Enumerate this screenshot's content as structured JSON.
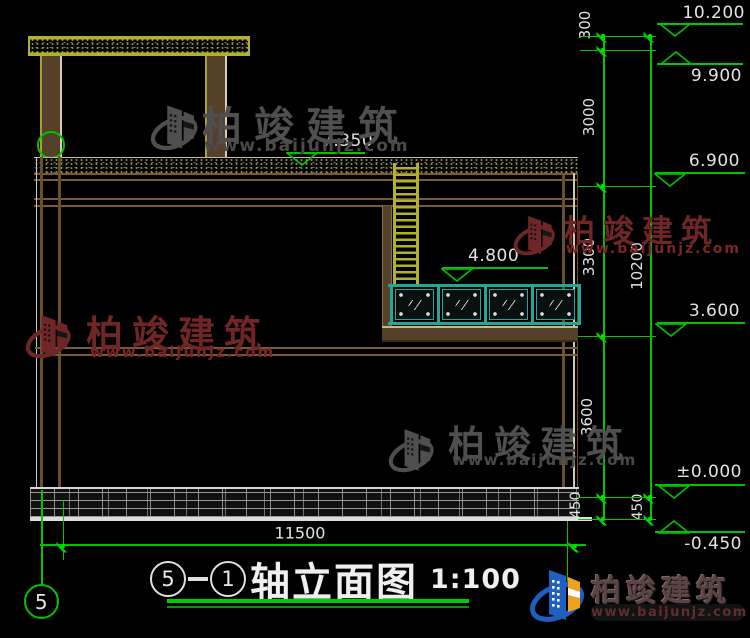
{
  "title_bar": {
    "axis_a": "5",
    "axis_b": "1",
    "name": "轴立面图",
    "scale": "1:100"
  },
  "axis_bubble_label": "5",
  "brand": {
    "name": "柏竣建筑",
    "site": "www.baijunjz.com"
  },
  "colors": {
    "dim_green": "#00c400",
    "cad_yellow": "#b2b22a",
    "wall_brown": "#7a5a35",
    "rail_teal": "#1fa89a",
    "wm_gray": "#4f4f4f",
    "wm_red": "#702626",
    "logo_blue": "#1e5fc0",
    "logo_orange": "#f0a21e"
  },
  "drawing": {
    "bottom_dimension": {
      "label": "11500",
      "cx": 300,
      "cy": 533,
      "line": [
        40,
        586,
        545
      ],
      "tick_x": [
        63,
        575
      ]
    },
    "elevation_markers": [
      {
        "label": "10.200",
        "line": [
          657,
          743,
          23
        ],
        "apex": [
          675,
          35
        ],
        "dir": "down",
        "text": [
          745,
          3,
          "right"
        ]
      },
      {
        "label": "9.900",
        "line": [
          657,
          743,
          63
        ],
        "apex": [
          676,
          50
        ],
        "dir": "up",
        "text": [
          742,
          66,
          "right"
        ]
      },
      {
        "label": "6.900",
        "line": [
          655,
          745,
          172
        ],
        "apex": [
          670,
          185
        ],
        "dir": "down",
        "text": [
          740,
          151,
          "right"
        ]
      },
      {
        "label": "3.600",
        "line": [
          657,
          745,
          322
        ],
        "apex": [
          671,
          335
        ],
        "dir": "down",
        "text": [
          740,
          301,
          "right"
        ]
      },
      {
        "label": "±0.000",
        "line": [
          655,
          745,
          484
        ],
        "apex": [
          674,
          497
        ],
        "dir": "down",
        "text": [
          742,
          462,
          "right"
        ]
      },
      {
        "label": "-0.450",
        "line": [
          655,
          745,
          531
        ],
        "apex": [
          674,
          519
        ],
        "dir": "up",
        "text": [
          742,
          534,
          "right"
        ]
      },
      {
        "label": "7.350",
        "line": [
          287,
          365,
          152
        ],
        "apex": [
          302,
          164
        ],
        "dir": "down",
        "text": [
          322,
          131,
          "left"
        ]
      },
      {
        "label": "4.800",
        "line": [
          442,
          548,
          267
        ],
        "apex": [
          457,
          280
        ],
        "dir": "down",
        "text": [
          468,
          246,
          "left"
        ]
      }
    ],
    "dim_chain_labels": [
      {
        "text": "300",
        "cx": 585,
        "cy": 25,
        "size": 15
      },
      {
        "text": "3000",
        "cx": 589,
        "cy": 117,
        "size": 15
      },
      {
        "text": "3300",
        "cx": 589,
        "cy": 257,
        "size": 15
      },
      {
        "text": "3600",
        "cx": 587,
        "cy": 417,
        "size": 15
      },
      {
        "text": "450",
        "cx": 576,
        "cy": 505,
        "size": 14
      },
      {
        "text": "10200",
        "cx": 637,
        "cy": 266,
        "size": 15
      },
      {
        "text": "450",
        "cx": 638,
        "cy": 507,
        "size": 14
      }
    ],
    "chainA": {
      "x": 603,
      "y1": 36,
      "y2": 519,
      "ticks": [
        36,
        50,
        186,
        336,
        497,
        519
      ]
    },
    "chainB": {
      "x": 650,
      "y1": 36,
      "y2": 519,
      "ticks": [
        36,
        497,
        519
      ]
    },
    "ext_lines": [
      [
        580,
        656,
        36
      ],
      [
        580,
        656,
        50
      ],
      [
        578,
        656,
        186
      ],
      [
        578,
        656,
        336
      ],
      [
        578,
        656,
        497
      ],
      [
        578,
        656,
        519
      ]
    ],
    "glass_panels": {
      "x0": 390,
      "y": 284,
      "w": 188,
      "panel_y": 289,
      "panel_h": 31,
      "count": 4,
      "mullion_w": 3
    }
  },
  "watermarks": [
    {
      "chars": "柏竣建筑",
      "www": "www.baijunjz.com",
      "icon": [
        150,
        94,
        50,
        66
      ],
      "char_x": 202,
      "char_y": 94,
      "char_size": 40,
      "char_ls": 12,
      "www_x": 204,
      "www_y": 136,
      "www_size": 17,
      "color": "#4f4f4f",
      "www_color": "#4a4a4a"
    },
    {
      "chars": "柏竣建筑",
      "www": "www.baijunjz.com",
      "icon": [
        513,
        204,
        44,
        62
      ],
      "char_x": 564,
      "char_y": 206,
      "char_size": 31,
      "char_ls": 8,
      "www_x": 566,
      "www_y": 241,
      "www_size": 14,
      "color": "#702626",
      "www_color": "#7a2424"
    },
    {
      "chars": "柏竣建筑",
      "www": "www.baijunjz.com",
      "icon": [
        25,
        304,
        48,
        64
      ],
      "char_x": 86,
      "char_y": 304,
      "char_size": 37,
      "char_ls": 9,
      "www_x": 90,
      "www_y": 343,
      "www_size": 15,
      "color": "#702626",
      "www_color": "#7a2424"
    },
    {
      "chars": "柏竣建筑",
      "www": "www.baijunjz.com",
      "icon": [
        388,
        417,
        48,
        66
      ],
      "char_x": 448,
      "char_y": 414,
      "char_size": 37,
      "char_ls": 9,
      "www_x": 452,
      "www_y": 451,
      "www_size": 15,
      "color": "#4f4f4f",
      "www_color": "#4a4a4a"
    }
  ]
}
